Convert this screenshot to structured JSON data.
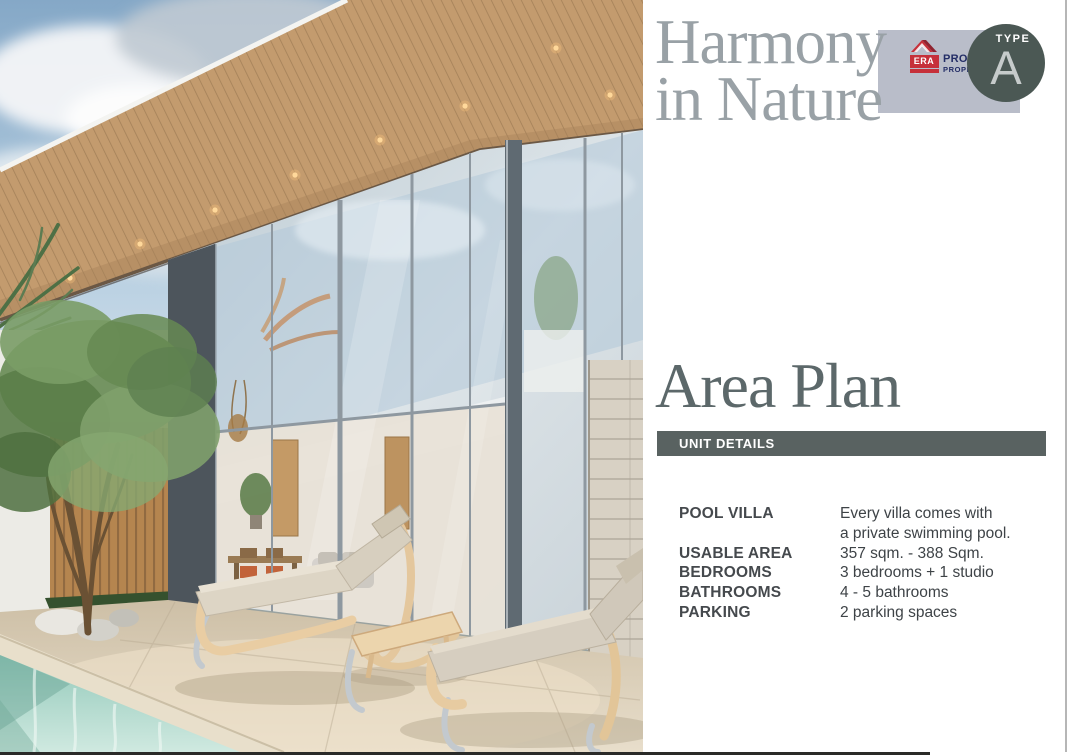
{
  "hero": {
    "title_line1": "Harmony",
    "title_line2": "in Nature"
  },
  "badge": {
    "type_label": "TYPE",
    "type_value": "A"
  },
  "logo": {
    "era": "ERA",
    "prompt": "PROMPT",
    "property": "PROPERTY"
  },
  "section": {
    "heading": "Area Plan",
    "bar_label": "UNIT DETAILS"
  },
  "details": [
    {
      "label": "POOL VILLA",
      "line1": "Every villa comes with",
      "line2": "a private swimming pool."
    },
    {
      "label": "USABLE AREA",
      "line1": "357 sqm. - 388 Sqm."
    },
    {
      "label": "BEDROOMS",
      "line1": "3 bedrooms + 1 studio"
    },
    {
      "label": "BATHROOMS",
      "line1": "4 - 5 bathrooms"
    },
    {
      "label": "PARKING",
      "line1": "2 parking spaces"
    }
  ],
  "colors": {
    "hero_title": "#99a1a6",
    "section_heading": "#5c686a",
    "unit_bar_bg": "#596261",
    "badge_rect": "#b9bdc9",
    "badge_circle": "#4b5854",
    "badge_letter": "#c6cbcb",
    "logo_red": "#c6303a",
    "logo_navy": "#232d66",
    "detail_label": "#45494d",
    "detail_value": "#3e4347",
    "pool_water": "#9ccfc0",
    "roof_wood": "#c39b6e"
  }
}
